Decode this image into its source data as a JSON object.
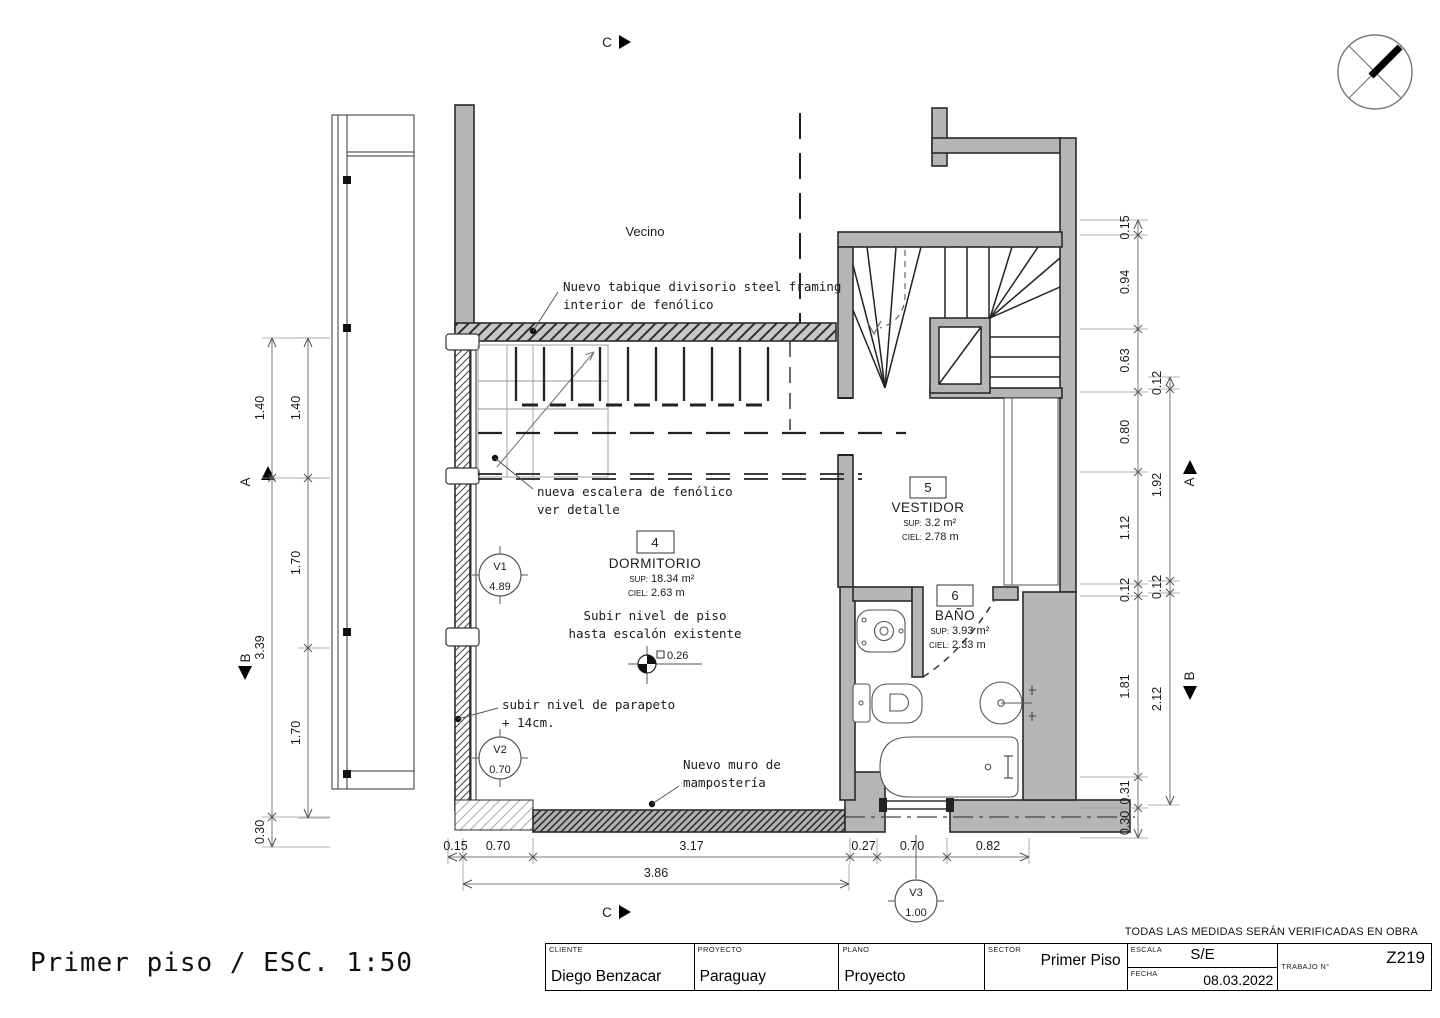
{
  "title": "Primer piso / ESC. 1:50",
  "labels": {
    "vecino": "Vecino"
  },
  "section_markers": {
    "c_top": "C",
    "c_bottom": "C",
    "a_left": "A",
    "b_left": "B",
    "a_right": "A",
    "b_right": "B"
  },
  "annotations": {
    "tabique_line1": "Nuevo tabique divisorio steel framing",
    "tabique_line2": "interior de fenólico",
    "escalera_line1": "nueva escalera de fenólico",
    "escalera_line2": "ver detalle",
    "subir_piso_line1": "Subir nivel de piso",
    "subir_piso_line2": "hasta escalón existente",
    "nivel_value": "0.26",
    "parapeto_line1": "subir nivel de parapeto",
    "parapeto_line2": "+ 14cm.",
    "muro_line1": "Nuevo muro de",
    "muro_line2": "mampostería"
  },
  "rooms": [
    {
      "number": "4",
      "name": "DORMITORIO",
      "sup_label": "SUP:",
      "sup": "18.34 m²",
      "ciel_label": "CIEL:",
      "ciel": "2.63 m"
    },
    {
      "number": "5",
      "name": "VESTIDOR",
      "sup_label": "SUP:",
      "sup": "3.2 m²",
      "ciel_label": "CIEL:",
      "ciel": "2.78 m"
    },
    {
      "number": "6",
      "name": "BAÑO",
      "sup_label": "SUP:",
      "sup": "3.93 m²",
      "ciel_label": "CIEL:",
      "ciel": "2.33 m"
    }
  ],
  "windows": [
    {
      "id": "V1",
      "value": "4.89"
    },
    {
      "id": "V2",
      "value": "0.70"
    },
    {
      "id": "V3",
      "value": "1.00"
    }
  ],
  "dimensions": {
    "left_outer": [
      "1.40",
      "3.39",
      "0.30"
    ],
    "left_inner": [
      "1.40",
      "1.70",
      "1.70"
    ],
    "right_inner": [
      "0.15",
      "0.94",
      "0.63",
      "0.80",
      "1.12",
      "0.12",
      "1.81",
      "0.31",
      "0.30"
    ],
    "right_outer": [
      "0.12",
      "1.92",
      "0.12",
      "2.12"
    ],
    "bottom_row1": [
      "0.15",
      "0.70",
      "3.17",
      "0.27",
      "0.70",
      "0.82"
    ],
    "bottom_row2": [
      "3.86"
    ]
  },
  "titleblock": {
    "note": "TODAS LAS MEDIDAS SERÁN VERIFICADAS EN OBRA",
    "cliente_label": "CLIENTE",
    "cliente": "Diego Benzacar",
    "proyecto_label": "PROYECTO",
    "proyecto": "Paraguay",
    "plano_label": "PLANO",
    "plano": "Proyecto",
    "sector_label": "SECTOR",
    "sector": "Primer Piso",
    "escala_label": "ESCALA",
    "escala": "S/E",
    "fecha_label": "FECHA",
    "fecha": "08.03.2022",
    "trabajo_label": "TRABAJO N°",
    "trabajo": "Z219"
  }
}
